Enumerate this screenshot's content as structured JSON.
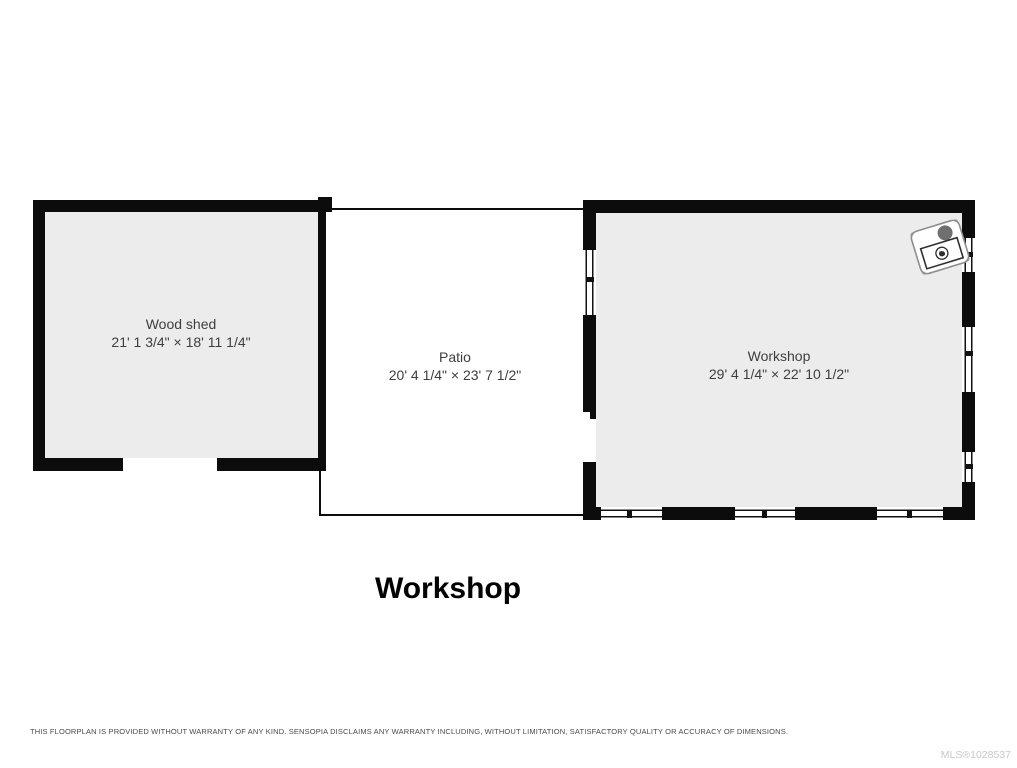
{
  "page": {
    "title": "Workshop",
    "footer": {
      "disclaimer": "THIS FLOORPLAN IS PROVIDED WITHOUT WARRANTY OF ANY KIND. SENSOPIA DISCLAIMS ANY WARRANTY INCLUDING, WITHOUT LIMITATION, SATISFACTORY QUALITY OR ACCURACY OF DIMENSIONS.",
      "mls_number": "MLS®1028537"
    }
  },
  "floorplan": {
    "rooms": [
      {
        "id": "wood-shed",
        "name": "Wood shed",
        "dimensions": "21' 1 3/4\" × 18' 11 1/4\""
      },
      {
        "id": "patio",
        "name": "Patio",
        "dimensions": "20' 4 1/4\" × 23' 7 1/2\""
      },
      {
        "id": "workshop",
        "name": "Workshop",
        "dimensions": "29' 4 1/4\" × 22' 10 1/2\""
      }
    ],
    "fixtures": [
      {
        "name": "wood stove",
        "icon": "wood-stove-icon"
      }
    ],
    "colors": {
      "wall": "#0c0c0c",
      "room_fill": "#ececec",
      "patio_fill": "#ffffff",
      "label_text": "#3e3e3e",
      "title_text": "#000000",
      "disclaimer_text": "#4a4a4a",
      "mls_text": "#c9c9c9"
    }
  }
}
